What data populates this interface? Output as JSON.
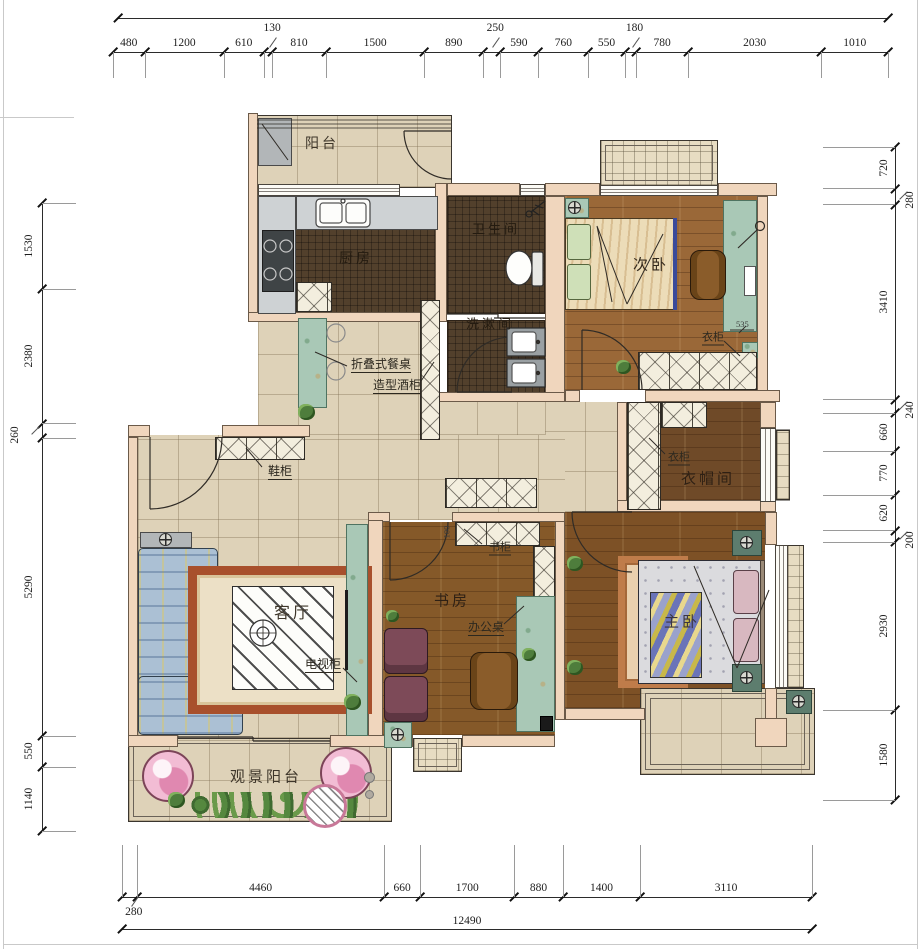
{
  "plan": {
    "rooms": [
      {
        "id": "balcony-top",
        "label": "阳台"
      },
      {
        "id": "kitchen",
        "label": "厨房"
      },
      {
        "id": "bathroom",
        "label": "卫生间"
      },
      {
        "id": "washroom",
        "label": "洗漱间"
      },
      {
        "id": "bedroom-second",
        "label": "次卧"
      },
      {
        "id": "cloakroom",
        "label": "衣帽间"
      },
      {
        "id": "living-room",
        "label": "客厅"
      },
      {
        "id": "study",
        "label": "书房"
      },
      {
        "id": "bedroom-master",
        "label": "主卧"
      },
      {
        "id": "balcony-view",
        "label": "观景阳台"
      }
    ],
    "annotations": [
      {
        "id": "folding-table",
        "label": "折叠式餐桌"
      },
      {
        "id": "wine-cabinet",
        "label": "造型酒柜"
      },
      {
        "id": "shoe-cabinet",
        "label": "鞋柜"
      },
      {
        "id": "wardrobe-bedroom",
        "label": "衣柜"
      },
      {
        "id": "wardrobe-cloak",
        "label": "衣柜"
      },
      {
        "id": "bookcase",
        "label": "书柜"
      },
      {
        "id": "desk",
        "label": "办公桌"
      },
      {
        "id": "tv-cabinet",
        "label": "电视柜"
      }
    ],
    "inline_dims": [
      {
        "id": "wardrobe-width",
        "value": "535"
      },
      {
        "id": "study-door",
        "value": "100"
      }
    ],
    "dimensions": {
      "top": [
        480,
        1200,
        610,
        130,
        810,
        1500,
        890,
        250,
        590,
        760,
        550,
        180,
        780,
        2030,
        1010
      ],
      "left": [
        1530,
        2380,
        260,
        5290,
        550,
        1140
      ],
      "right": [
        720,
        280,
        3410,
        240,
        660,
        770,
        620,
        200,
        2930,
        1580
      ],
      "bottom": [
        280,
        4460,
        660,
        1700,
        880,
        1400,
        3110
      ],
      "total_width": 12490
    },
    "colors": {
      "wall": "#f0d6bd",
      "tile": "#ded2b8",
      "dark_tile": "#52402c",
      "wood": "#8a5a32",
      "accent_teal": "#a9c8b6",
      "dim_text": "#1d1d1d"
    }
  }
}
